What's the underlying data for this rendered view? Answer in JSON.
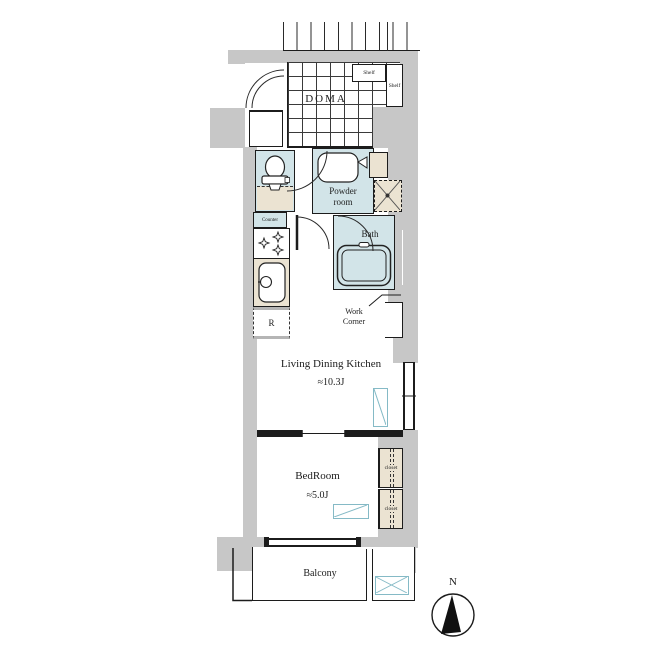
{
  "rooms": {
    "doma": {
      "label": "DOMA"
    },
    "powder": {
      "line1": "Powder",
      "line2": "room"
    },
    "bath": {
      "label": "Bath"
    },
    "work_corner": {
      "line1": "Work",
      "line2": "Corner"
    },
    "ldk": {
      "name": "Living Dining Kitchen",
      "size": "≈10.3J"
    },
    "bedroom": {
      "name": "BedRoom",
      "size": "≈5.0J"
    },
    "balcony": {
      "label": "Balcony"
    }
  },
  "fixtures": {
    "shelf_top": "Shelf",
    "shelf_side": "Shelf",
    "counter": "Counter",
    "refrigerator": "R",
    "closet_upper": "closet",
    "closet_lower": "closet"
  },
  "compass": {
    "north": "N"
  },
  "colors": {
    "wall": "#c7c7c7",
    "wet": "#d2e4e8",
    "tan": "#ebe3d2",
    "teal": "#85bac6"
  }
}
